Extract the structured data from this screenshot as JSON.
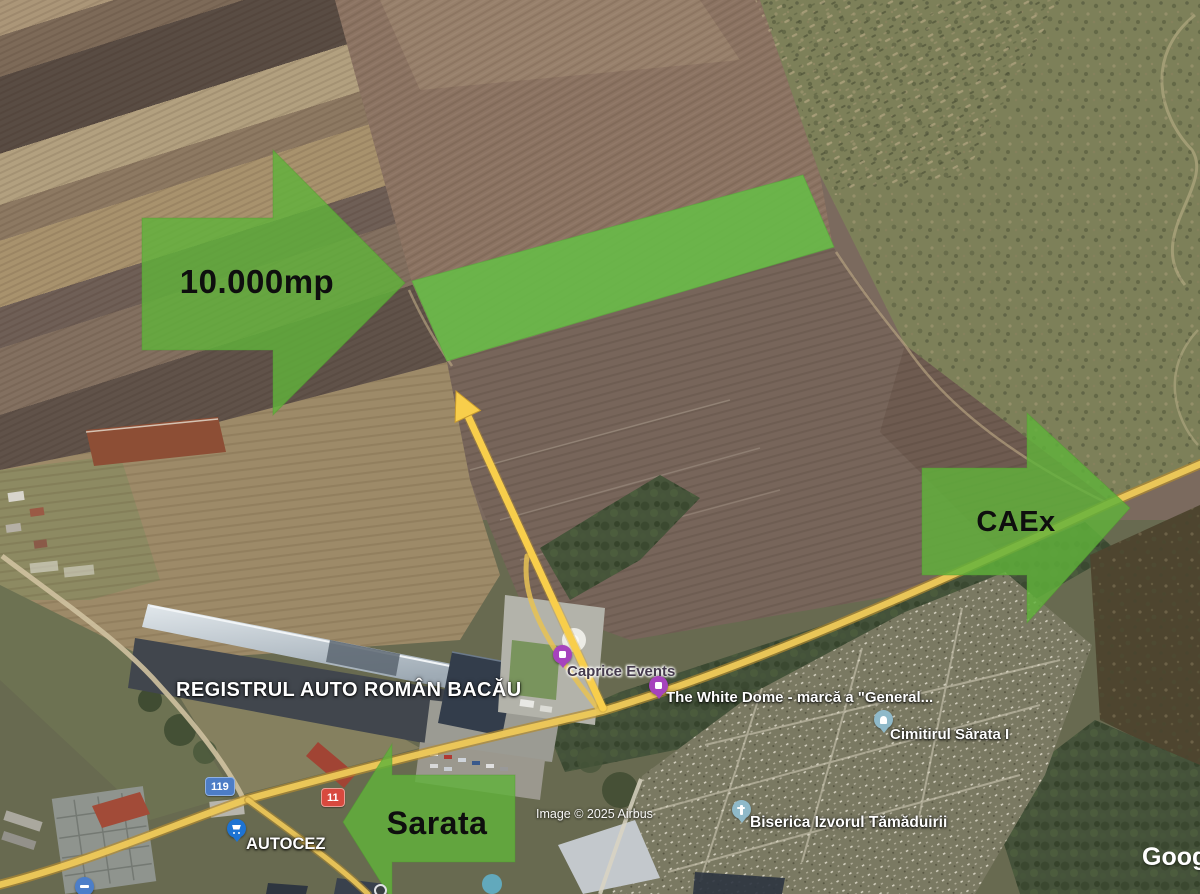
{
  "annotations": {
    "area": {
      "label": "10.000mp"
    },
    "route_right": {
      "label": "CAEx"
    },
    "route_left": {
      "label": "Sarata"
    }
  },
  "map_labels": {
    "rar": "REGISTRUL AUTO ROMÂN BACĂU",
    "caprice_events": "Caprice Events",
    "white_dome": "The White Dome -  marcă a \"General...",
    "cemetery": "Cimitirul Sărata I",
    "church": "Biserica Izvorul Tămăduirii",
    "autocez": "AUTOCEZ"
  },
  "road_badges": {
    "badge_119": "119",
    "badge_11": "11"
  },
  "attribution": {
    "imagery_credit": "Image © 2025 Airbus",
    "brand_watermark": "Google"
  },
  "icons": {
    "event_pin": "purple-venue-pin",
    "cemetery_pin": "teal-tombstone-pin",
    "church_pin": "teal-cross-pin",
    "store_pin": "blue-shopping-cart-pin",
    "arrow_up": "yellow-direction-arrow"
  },
  "colors": {
    "annotation_green": "#60b23a",
    "highlight_strip_green": "#68ba48",
    "annotation_yellow": "#f8ce4b",
    "road_overlay_yellow": "#eec95a",
    "badge_blue": "#4d7dc6",
    "badge_red": "#d8493e",
    "poi_purple": "#a643bd",
    "poi_teal": "#8fb9c9",
    "poi_blue": "#1d73d3"
  }
}
